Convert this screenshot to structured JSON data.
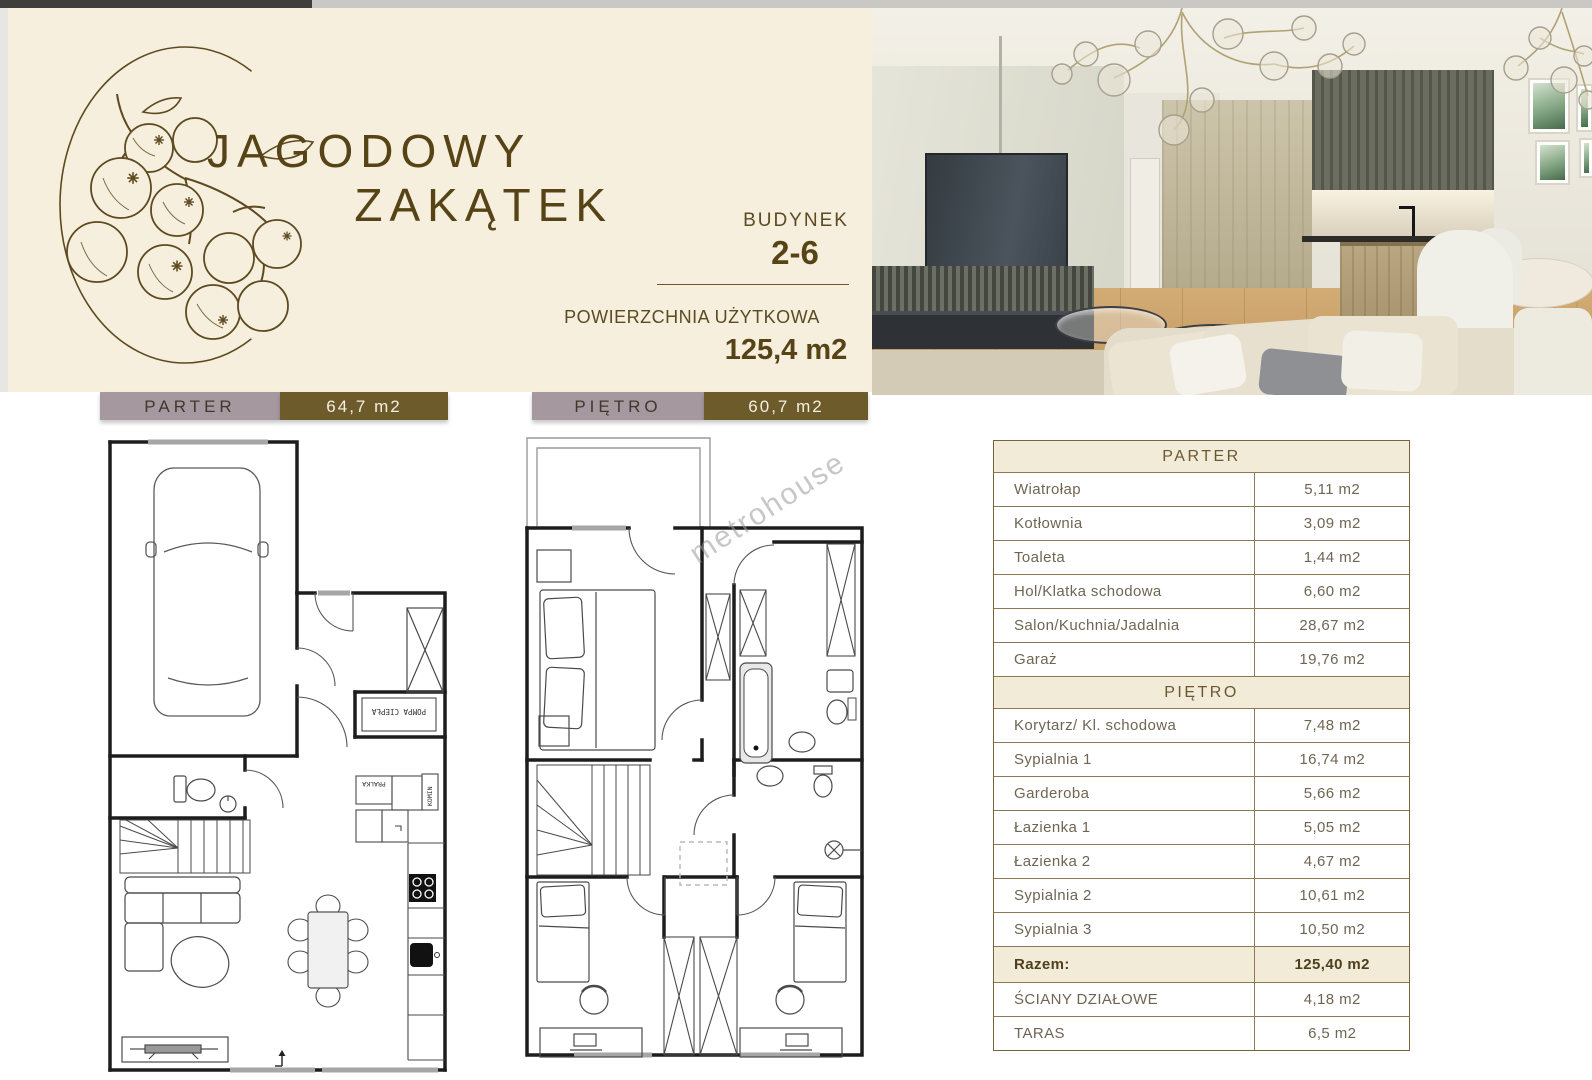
{
  "brand": {
    "title_line1": "JAGODOWY",
    "title_line2": "ZAKĄTEK"
  },
  "building": {
    "label": "BUDYNEK",
    "number": "2-6",
    "area_label": "POWIERZCHNIA UŻYTKOWA",
    "area_value": "125,4 m2"
  },
  "floor_tags": [
    {
      "name": "PARTER",
      "area": "64,7 m2"
    },
    {
      "name": "PIĘTRO",
      "area": "60,7 m2"
    }
  ],
  "plan_labels": {
    "pompa_ciepla": "POMPA CIEPŁA",
    "pralka": "PRALKA",
    "komin": "KOMIN",
    "watermark": "metrohouse"
  },
  "area_table": {
    "sections": [
      {
        "header": "PARTER",
        "rows": [
          {
            "label": "Wiatrołap",
            "value": "5,11 m2"
          },
          {
            "label": "Kotłownia",
            "value": "3,09 m2"
          },
          {
            "label": "Toaleta",
            "value": "1,44 m2"
          },
          {
            "label": "Hol/Klatka schodowa",
            "value": "6,60 m2"
          },
          {
            "label": "Salon/Kuchnia/Jadalnia",
            "value": "28,67 m2"
          },
          {
            "label": "Garaż",
            "value": "19,76 m2"
          }
        ]
      },
      {
        "header": "PIĘTRO",
        "rows": [
          {
            "label": "Korytarz/ Kl. schodowa",
            "value": "7,48 m2"
          },
          {
            "label": "Sypialnia 1",
            "value": "16,74 m2"
          },
          {
            "label": "Garderoba",
            "value": "5,66 m2"
          },
          {
            "label": "Łazienka 1",
            "value": "5,05 m2"
          },
          {
            "label": "Łazienka 2",
            "value": "4,67 m2"
          },
          {
            "label": "Sypialnia 2",
            "value": "10,61 m2"
          },
          {
            "label": "Sypialnia 3",
            "value": "10,50 m2"
          }
        ]
      }
    ],
    "total": {
      "label": "Razem:",
      "value": "125,40 m2"
    },
    "extras": [
      {
        "label": "ŚCIANY DZIAŁOWE",
        "value": "4,18 m2"
      },
      {
        "label": "TARAS",
        "value": "6,5 m2"
      }
    ]
  },
  "colors": {
    "banner_bg": "#f6efde",
    "brand_brown": "#574416",
    "tag_mauve": "#a6989f",
    "tag_olive": "#6d5b2b",
    "table_border": "#77643c",
    "table_header_bg": "#f2ebd8"
  }
}
